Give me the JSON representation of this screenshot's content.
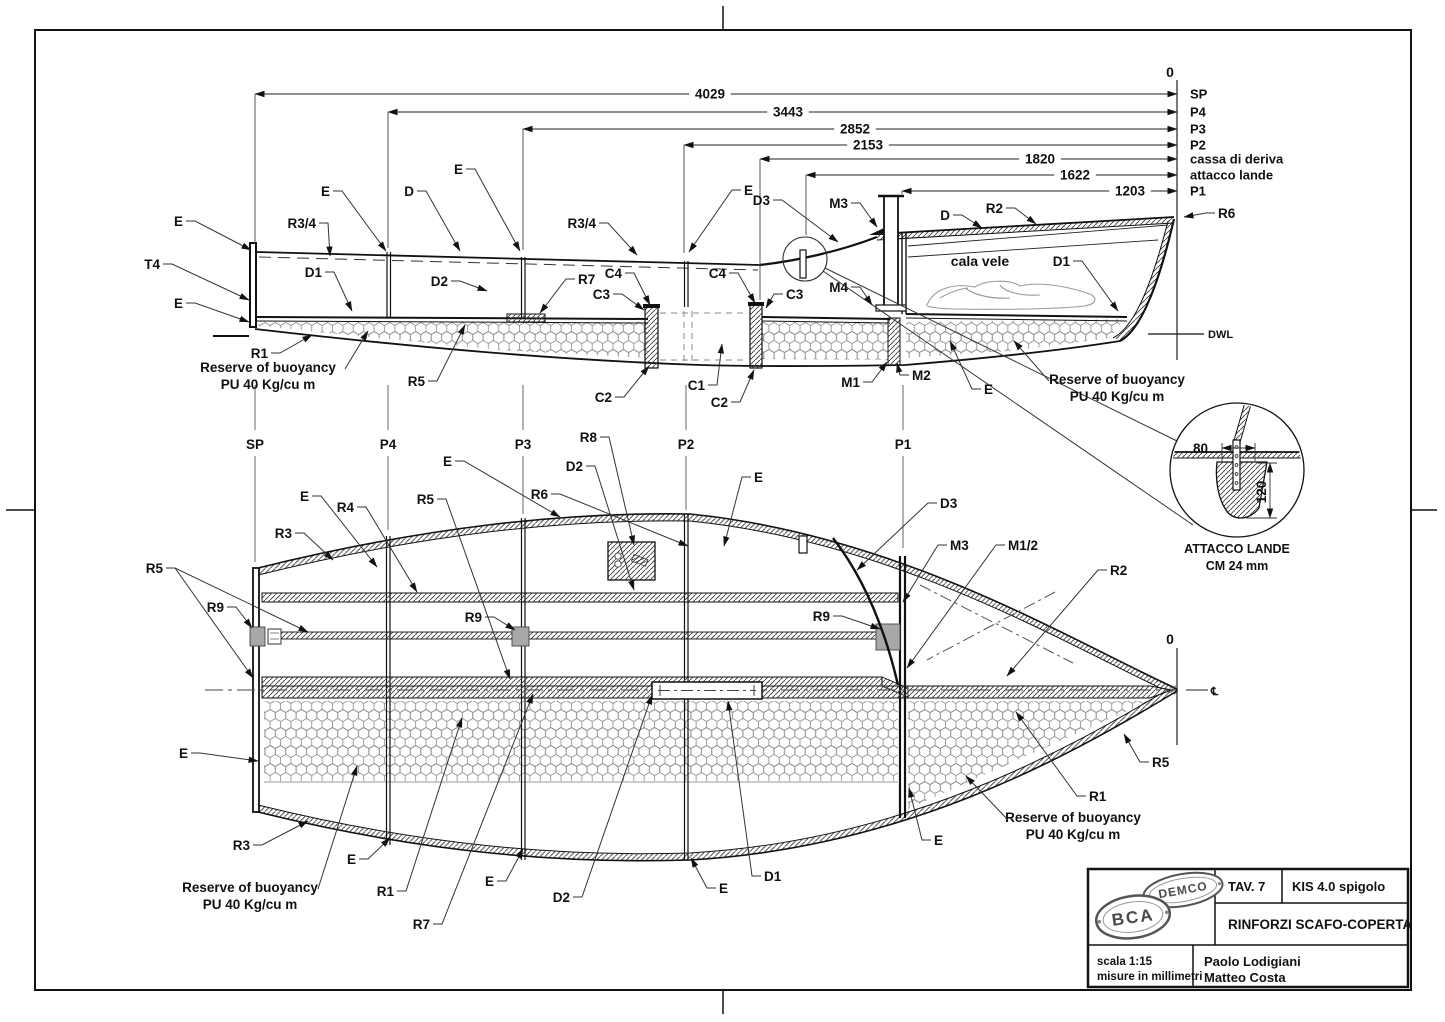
{
  "misc": {
    "zero_top": "0",
    "zero_bow": "0",
    "dwl": "DWL",
    "cl": "℄",
    "cala_vele": "cala vele"
  },
  "colors": {
    "line": "#1a1a1a",
    "hatch": "#3a3a3a",
    "hex": "#8a8a8a",
    "block": "#a8a8a8"
  },
  "dimensions": {
    "rows": [
      {
        "value": "4029",
        "station": "SP",
        "y": 94,
        "vx": 710,
        "sx": 255,
        "ext": 243
      },
      {
        "value": "3443",
        "station": "P4",
        "y": 112,
        "vx": 788,
        "sx": 388,
        "ext": 248
      },
      {
        "value": "2852",
        "station": "P3",
        "y": 129,
        "vx": 855,
        "sx": 523,
        "ext": 250
      },
      {
        "value": "2153",
        "station": "P2",
        "y": 145,
        "vx": 868,
        "sx": 684,
        "ext": 253
      },
      {
        "value": "1820",
        "station": "cassa di deriva",
        "y": 159,
        "vx": 1040,
        "sx": 760,
        "ext": 300
      },
      {
        "value": "1622",
        "station": "attacco lande",
        "y": 175,
        "vx": 1075,
        "sx": 806,
        "ext": 235
      },
      {
        "value": "1203",
        "station": "P1",
        "y": 191,
        "vx": 1130,
        "sx": 902,
        "ext": 194
      }
    ]
  },
  "stations": [
    {
      "label": "SP",
      "x": 255,
      "yend": 562
    },
    {
      "label": "P4",
      "x": 388,
      "yend": 530
    },
    {
      "label": "P3",
      "x": 523,
      "yend": 514
    },
    {
      "label": "P2",
      "x": 686,
      "yend": 510
    },
    {
      "label": "P1",
      "x": 903,
      "yend": 548
    }
  ],
  "profile_labels": [
    {
      "t": "E",
      "x": 183,
      "y": 221,
      "lx": 251,
      "ly": 250
    },
    {
      "t": "T4",
      "x": 160,
      "y": 264,
      "lx": 249,
      "ly": 300
    },
    {
      "t": "E",
      "x": 183,
      "y": 303,
      "lx": 249,
      "ly": 322
    },
    {
      "t": "R3/4",
      "x": 316,
      "y": 223,
      "lx": 330,
      "ly": 256
    },
    {
      "t": "E",
      "x": 330,
      "y": 191,
      "lx": 386,
      "ly": 251
    },
    {
      "t": "D",
      "x": 414,
      "y": 191,
      "lx": 460,
      "ly": 251
    },
    {
      "t": "E",
      "x": 463,
      "y": 169,
      "lx": 520,
      "ly": 251
    },
    {
      "t": "R3/4",
      "x": 596,
      "y": 223,
      "lx": 637,
      "ly": 255
    },
    {
      "t": "D1",
      "x": 322,
      "y": 272,
      "lx": 352,
      "ly": 311
    },
    {
      "t": "D2",
      "x": 448,
      "y": 281,
      "lx": 487,
      "ly": 291
    },
    {
      "t": "R7",
      "x": 578,
      "y": 279,
      "lx": 540,
      "ly": 313
    },
    {
      "t": "C4",
      "x": 622,
      "y": 273,
      "lx": 650,
      "ly": 305
    },
    {
      "t": "C3",
      "x": 610,
      "y": 294,
      "lx": 644,
      "ly": 310
    },
    {
      "t": "C4",
      "x": 726,
      "y": 273,
      "lx": 755,
      "ly": 303
    },
    {
      "t": "C3",
      "x": 786,
      "y": 294,
      "lx": 766,
      "ly": 308
    },
    {
      "t": "E",
      "x": 744,
      "y": 190,
      "lx": 689,
      "ly": 252
    },
    {
      "t": "D3",
      "x": 770,
      "y": 200,
      "lx": 838,
      "ly": 242
    },
    {
      "t": "M3",
      "x": 848,
      "y": 203,
      "lx": 877,
      "ly": 227
    },
    {
      "t": "M4",
      "x": 848,
      "y": 287,
      "lx": 872,
      "ly": 305
    },
    {
      "t": "D",
      "x": 950,
      "y": 215,
      "lx": 982,
      "ly": 228
    },
    {
      "t": "R2",
      "x": 1003,
      "y": 208,
      "lx": 1036,
      "ly": 224
    },
    {
      "t": "D1",
      "x": 1070,
      "y": 261,
      "lx": 1118,
      "ly": 311
    },
    {
      "t": "R6",
      "x": 1218,
      "y": 213,
      "lx": 1184,
      "ly": 217
    },
    {
      "t": "C2",
      "x": 612,
      "y": 397,
      "lx": 649,
      "ly": 366
    },
    {
      "t": "C1",
      "x": 705,
      "y": 385,
      "lx": 722,
      "ly": 344
    },
    {
      "t": "C2",
      "x": 728,
      "y": 402,
      "lx": 754,
      "ly": 370
    },
    {
      "t": "M1",
      "x": 860,
      "y": 382,
      "lx": 887,
      "ly": 362
    },
    {
      "t": "M2",
      "x": 912,
      "y": 375,
      "lx": 897,
      "ly": 363
    },
    {
      "t": "E",
      "x": 984,
      "y": 389,
      "lx": 950,
      "ly": 341
    },
    {
      "t": "R1",
      "x": 268,
      "y": 353,
      "lx": 312,
      "ly": 335
    },
    {
      "t": "R5",
      "x": 425,
      "y": 381,
      "lx": 465,
      "ly": 325
    }
  ],
  "plan_labels": [
    {
      "t": "R3",
      "x": 292,
      "y": 533,
      "lx": 333,
      "ly": 560
    },
    {
      "t": "E",
      "x": 309,
      "y": 496,
      "lx": 377,
      "ly": 567
    },
    {
      "t": "R4",
      "x": 354,
      "y": 507,
      "lx": 417,
      "ly": 592
    },
    {
      "t": "R5",
      "x": 434,
      "y": 499,
      "lx": 510,
      "ly": 679
    },
    {
      "t": "E",
      "x": 452,
      "y": 461,
      "lx": 560,
      "ly": 517
    },
    {
      "t": "R6",
      "x": 548,
      "y": 494,
      "lx": 688,
      "ly": 546
    },
    {
      "t": "D2",
      "x": 583,
      "y": 466,
      "lx": 634,
      "ly": 590
    },
    {
      "t": "E",
      "x": 754,
      "y": 477,
      "lx": 724,
      "ly": 546
    },
    {
      "t": "D3",
      "x": 940,
      "y": 503,
      "lx": 857,
      "ly": 570
    },
    {
      "t": "M3",
      "x": 950,
      "y": 545,
      "lx": 903,
      "ly": 602
    },
    {
      "t": "M1/2",
      "x": 1008,
      "y": 545,
      "lx": 907,
      "ly": 668
    },
    {
      "t": "R2",
      "x": 1110,
      "y": 570,
      "lx": 1007,
      "ly": 676
    },
    {
      "t": "R9",
      "x": 224,
      "y": 607,
      "lx": 252,
      "ly": 628
    },
    {
      "t": "R9",
      "x": 482,
      "y": 617,
      "lx": 515,
      "ly": 630
    },
    {
      "t": "R9",
      "x": 830,
      "y": 616,
      "lx": 880,
      "ly": 629
    },
    {
      "t": "R5",
      "x": 163,
      "y": 568,
      "lx": 308,
      "ly": 632,
      "lx2": 253,
      "ly2": 678
    },
    {
      "t": "E",
      "x": 188,
      "y": 753,
      "lx": 258,
      "ly": 761
    },
    {
      "t": "R3",
      "x": 250,
      "y": 845,
      "lx": 308,
      "ly": 821
    },
    {
      "t": "E",
      "x": 356,
      "y": 859,
      "lx": 390,
      "ly": 838
    },
    {
      "t": "R1",
      "x": 394,
      "y": 891,
      "lx": 462,
      "ly": 718
    },
    {
      "t": "R7",
      "x": 430,
      "y": 924,
      "lx": 533,
      "ly": 694
    },
    {
      "t": "E",
      "x": 494,
      "y": 881,
      "lx": 523,
      "ly": 849
    },
    {
      "t": "D2",
      "x": 570,
      "y": 897,
      "lx": 652,
      "ly": 695
    },
    {
      "t": "E",
      "x": 719,
      "y": 888,
      "lx": 691,
      "ly": 858
    },
    {
      "t": "D1",
      "x": 764,
      "y": 876,
      "lx": 728,
      "ly": 701
    },
    {
      "t": "R5",
      "x": 1152,
      "y": 762,
      "lx": 1124,
      "ly": 734
    },
    {
      "t": "R1",
      "x": 1089,
      "y": 796,
      "lx": 1016,
      "ly": 712
    },
    {
      "t": "E",
      "x": 934,
      "y": 840,
      "lx": 909,
      "ly": 788
    },
    {
      "t": "R8",
      "x": 597,
      "y": 437,
      "lx": 634,
      "ly": 545
    }
  ],
  "notes": [
    {
      "lines": [
        "Reserve of buoyancy",
        "PU 40 Kg/cu m"
      ],
      "cx": 268,
      "y": 372,
      "sx": 345,
      "sy": 369,
      "lx": 368,
      "ly": 331
    },
    {
      "lines": [
        "Reserve of buoyancy",
        "PU 40 Kg/cu m"
      ],
      "cx": 1117,
      "y": 384,
      "sx": 1049,
      "sy": 381,
      "lx": 1014,
      "ly": 341
    },
    {
      "lines": [
        "Reserve of buoyancy",
        "PU 40 Kg/cu m"
      ],
      "cx": 250,
      "y": 892,
      "sx": 318,
      "sy": 889,
      "lx": 357,
      "ly": 766
    },
    {
      "lines": [
        "Reserve of buoyancy",
        "PU 40 Kg/cu m"
      ],
      "cx": 1073,
      "y": 822,
      "sx": 1008,
      "sy": 820,
      "lx": 966,
      "ly": 776
    }
  ],
  "detail": {
    "title": "ATTACCO LANDE",
    "subtitle": "CM 24 mm",
    "width": "80",
    "height": "120"
  },
  "title_block": {
    "tav": "TAV. 7",
    "code": "KIS 4.0 spigolo",
    "title": "RINFORZI SCAFO-COPERTA",
    "scale": "scala 1:15",
    "units": "misure in millimetri",
    "author1": "Paolo Lodigiani",
    "author2": "Matteo Costa",
    "logo1": "DEMCO",
    "logo2": "BCA"
  }
}
